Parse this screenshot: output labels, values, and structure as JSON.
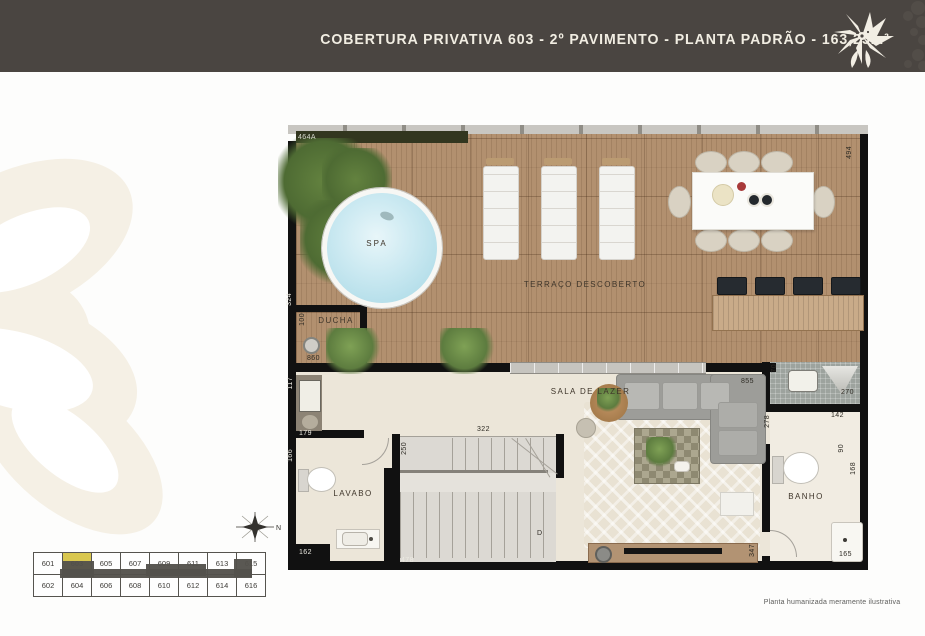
{
  "header": {
    "title": "COBERTURA PRIVATIVA 603 - 2º PAVIMENTO - PLANTA PADRÃO - 163,25m²"
  },
  "plan": {
    "rooms": {
      "spa": "SPA",
      "terraco": "TERRAÇO DESCOBERTO",
      "ducha": "DUCHA",
      "sala": "SALA DE LAZER",
      "lavabo": "LAVABO",
      "banho": "BANHO"
    },
    "dims": {
      "top_left": "464A",
      "right_top": "494",
      "left_upper": "324",
      "ducha_height": "100",
      "ducha_width": "860",
      "entry_wall": "117",
      "entry_width": "179",
      "lavabo_height": "166",
      "lavabo_width": "162",
      "stairs_height": "250",
      "stairs_width": "322",
      "stairs_bottom": "478",
      "stairs_letter": "D",
      "sala_width": "855",
      "nook_height": "70",
      "nook_width": "270",
      "banho_top": "142",
      "banho_left": "278",
      "banho_mid": "90",
      "banho_right": "168",
      "banho_door": "347",
      "banho_bottom": "165"
    }
  },
  "keyplan": {
    "rows": [
      [
        "601",
        "603",
        "605",
        "607",
        "609",
        "611",
        "613",
        "615"
      ],
      [
        "602",
        "604",
        "606",
        "608",
        "610",
        "612",
        "614",
        "616"
      ]
    ],
    "highlight": "603",
    "north": "N"
  },
  "footer": {
    "disclaimer": "Planta humanizada meramente ilustrativa"
  },
  "colors": {
    "header_bg": "#4a4541",
    "accent_yellow": "#d9c74f",
    "deck_wood": "#b2906f",
    "pool_water": "#c8e7f1"
  }
}
